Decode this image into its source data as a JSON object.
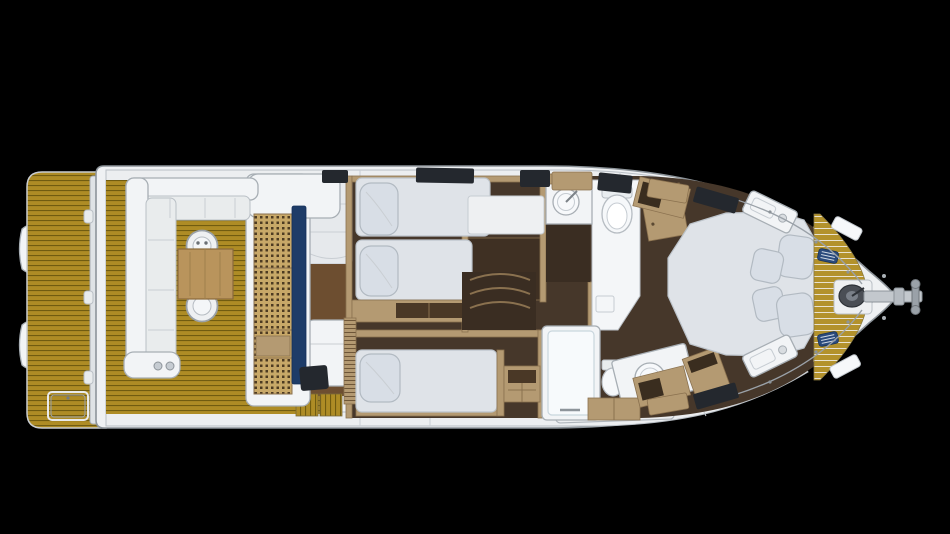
{
  "scene": {
    "type": "yacht-interior-floorplan",
    "view": "top-down",
    "orientation": "bow-right-stern-left",
    "background": "#000000"
  },
  "palette": {
    "background": "#000000",
    "hull": "#eff1f3",
    "hull_outline": "#8d949a",
    "inner_line": "#b9bfc5",
    "teak": "#ae8c25",
    "teak_gap": "#715c10",
    "foredeck_seam": "#e9e2cf",
    "oak": "#b49a72",
    "oak_edge": "#8a714f",
    "walnut_floor": "#46372a",
    "helm_floor": "#6d4e30",
    "mattress": "#dfe3e8",
    "pillow": "#d8dee6",
    "fixture_white": "#f2f4f6",
    "fixture_outline": "#a7aeb4",
    "galley_navy": "#1e3c68",
    "cleat_navy": "#2a4a7c",
    "vent_dark": "#24282e",
    "steel": "#c3c8cd",
    "windlass": "#4a4e55"
  },
  "elements": [
    {
      "name": "stern-tender-pods",
      "kind": "equipment",
      "count": 2
    },
    {
      "name": "swim-platform",
      "kind": "deck",
      "surface": "teak"
    },
    {
      "name": "platform-hatch",
      "kind": "fitting"
    },
    {
      "name": "cockpit",
      "kind": "deck",
      "surface": "teak"
    },
    {
      "name": "cockpit-sofa",
      "kind": "furniture",
      "shape": "L"
    },
    {
      "name": "cockpit-table",
      "kind": "furniture",
      "material": "wood"
    },
    {
      "name": "cockpit-chairs",
      "kind": "furniture",
      "count": 2
    },
    {
      "name": "wet-bar",
      "kind": "furniture"
    },
    {
      "name": "aft-galley",
      "kind": "room",
      "counter": "perforated-teak",
      "accent": "navy"
    },
    {
      "name": "helm-salon",
      "kind": "room"
    },
    {
      "name": "vip-cabin",
      "kind": "cabin",
      "berths": 2,
      "pillows": 2
    },
    {
      "name": "guest-cabin",
      "kind": "cabin",
      "berths": 1,
      "pillows": 1
    },
    {
      "name": "day-head",
      "kind": "bathroom",
      "fixtures": [
        "sink",
        "toilet"
      ]
    },
    {
      "name": "master-bathroom",
      "kind": "bathroom",
      "fixtures": [
        "shower",
        "sink",
        "toilet"
      ]
    },
    {
      "name": "master-cabin",
      "kind": "cabin",
      "bed": "island",
      "pillows": 4,
      "nightstands": 2
    },
    {
      "name": "foredeck",
      "kind": "deck",
      "surface": "teak-crescent"
    },
    {
      "name": "windlass",
      "kind": "equipment"
    },
    {
      "name": "bow-cleats",
      "kind": "fitting",
      "count": 2
    },
    {
      "name": "anchor-roller",
      "kind": "equipment"
    },
    {
      "name": "side-decks",
      "kind": "deck"
    }
  ]
}
